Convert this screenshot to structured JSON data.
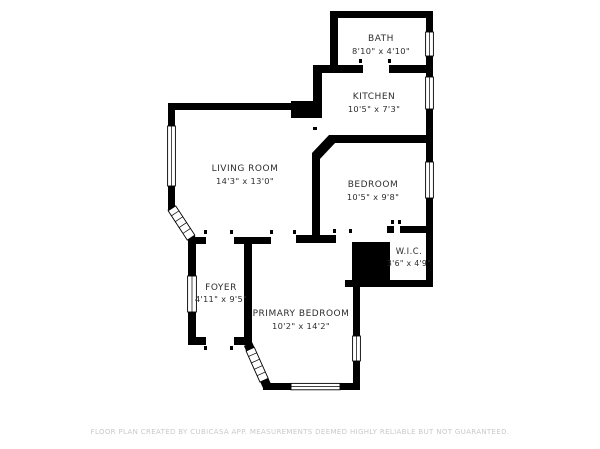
{
  "rooms": {
    "bath": {
      "name": "BATH",
      "dims": "8'10\" x 4'10\""
    },
    "kitchen": {
      "name": "KITCHEN",
      "dims": "10'5\" x 7'3\""
    },
    "living_room": {
      "name": "LIVING ROOM",
      "dims": "14'3\" x 13'0\""
    },
    "bedroom": {
      "name": "BEDROOM",
      "dims": "10'5\" x 9'8\""
    },
    "wic": {
      "name": "W.I.C.",
      "dims": "3'6\" x 4'9\""
    },
    "foyer": {
      "name": "FOYER",
      "dims": "4'11\" x 9'5\""
    },
    "primary_bedroom": {
      "name": "PRIMARY BEDROOM",
      "dims": "10'2\" x 14'2\""
    }
  },
  "footer": {
    "disclaimer": "FLOOR PLAN CREATED BY CUBICASA APP. MEASUREMENTS DEEMED HIGHLY RELIABLE BUT NOT GUARANTEED."
  },
  "colors": {
    "wall": "#000000",
    "background": "#ffffff",
    "label": "#2e2e2e",
    "disclaimer": "#c9c9c9"
  }
}
